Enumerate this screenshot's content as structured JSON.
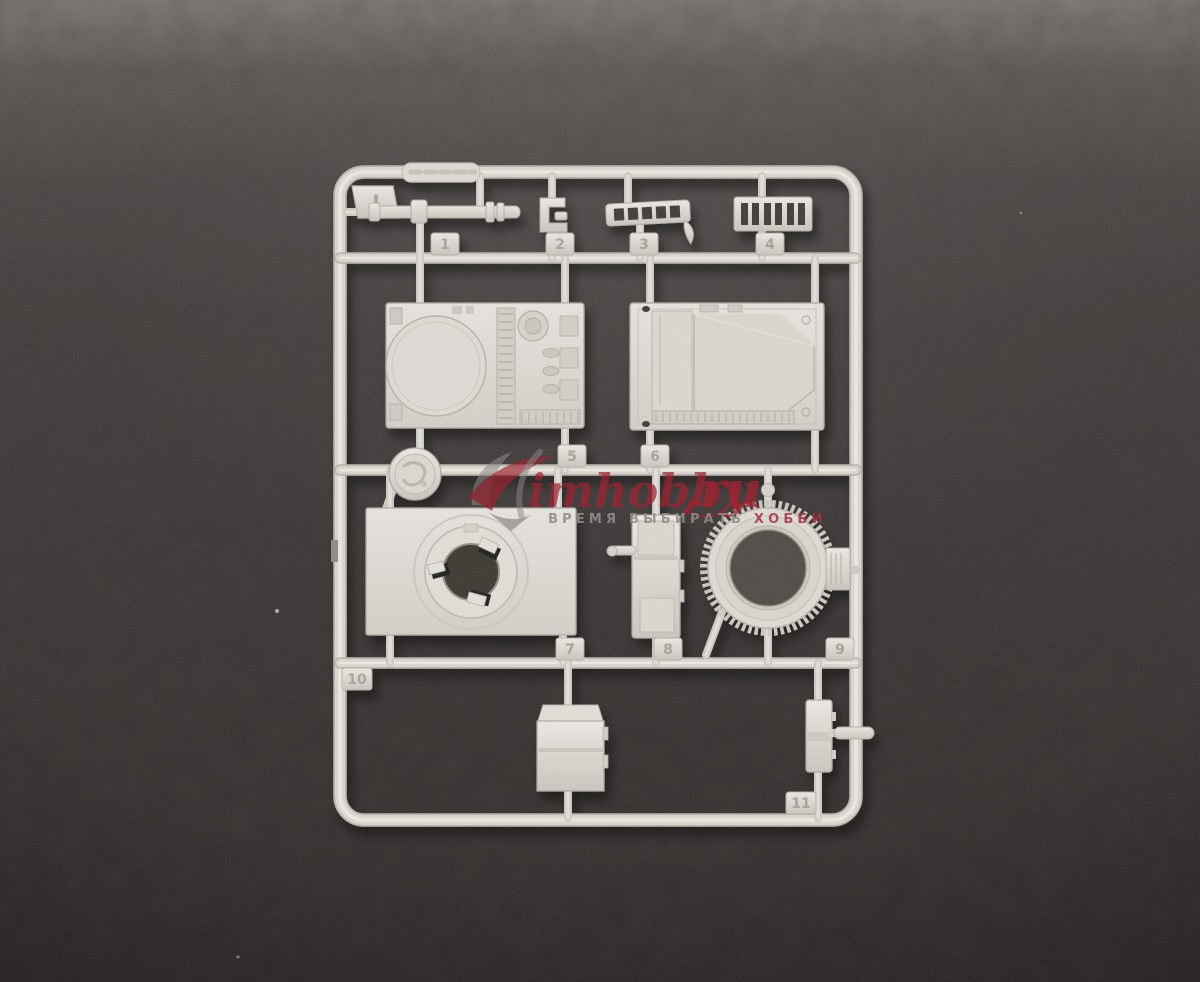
{
  "photo": {
    "description": "Injection-molded plastic model-kit sprue (runner J) with numbered parts, photographed on dark gray felt",
    "background_top_color": "#7b7873",
    "background_bottom_color": "#272422",
    "plastic_color": "#d8d5ce"
  },
  "sprue": {
    "letter": "J",
    "tags": [
      "1",
      "2",
      "3",
      "4",
      "5",
      "6",
      "7",
      "8",
      "9",
      "10",
      "11"
    ],
    "parts": [
      "gun-barrel-rod",
      "clamp-bracket",
      "ladder-rack",
      "vent-grille",
      "engine-deck-panel",
      "hull-roof-panel",
      "round-hatch-disc",
      "turret-ring-plate",
      "side-box-panel",
      "toothed-ring-gear",
      "stowage-box",
      "small-box-with-rod"
    ]
  },
  "watermark": {
    "brand": "imhobby",
    "tld": ",ru",
    "tagline_gray": "ВРЕМЯ ВЫБИРАТЬ",
    "tagline_red": " ХОББИ",
    "red_color": "#9e2433",
    "gray_color": "#908d88"
  }
}
